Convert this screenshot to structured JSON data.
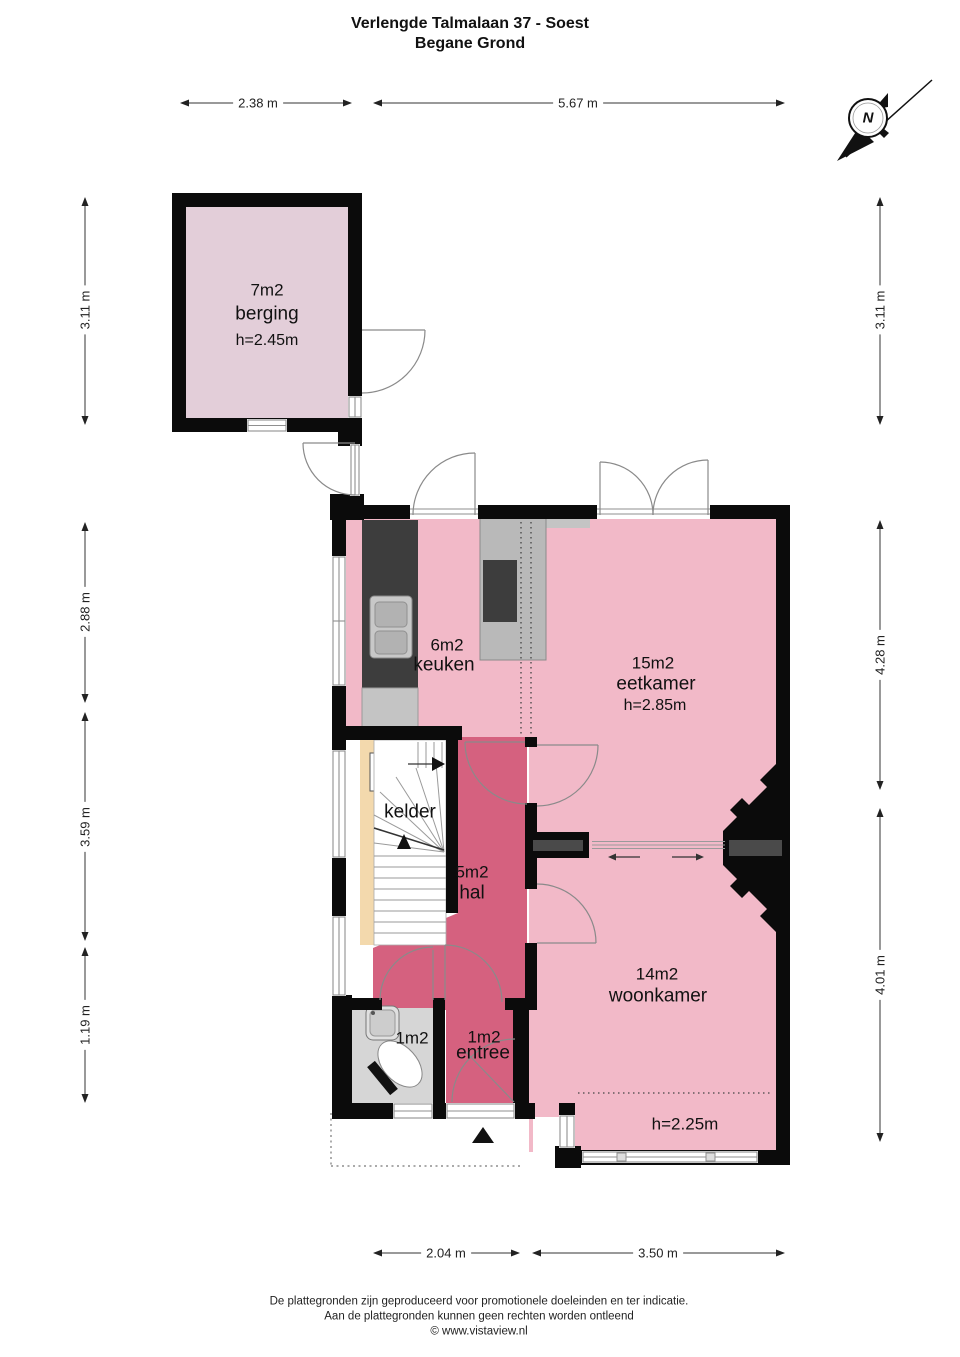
{
  "title": {
    "line1": "Verlengde Talmalaan 37 - Soest",
    "line2": "Begane Grond"
  },
  "compass": {
    "label": "N"
  },
  "rooms": {
    "berging": {
      "area": "7m2",
      "name": "berging",
      "height": "h=2.45m"
    },
    "keuken": {
      "area": "6m2",
      "name": "keuken"
    },
    "eetkamer": {
      "area": "15m2",
      "name": "eetkamer",
      "height": "h=2.85m"
    },
    "kelder": {
      "name": "kelder"
    },
    "hal": {
      "area": "5m2",
      "name": "hal"
    },
    "woonkamer": {
      "area": "14m2",
      "name": "woonkamer"
    },
    "toilet": {
      "area": "1m2"
    },
    "entree": {
      "area": "1m2",
      "name": "entree"
    },
    "ceiling_note": "h=2.25m"
  },
  "dimensions": {
    "top": [
      {
        "label": "2.38 m"
      },
      {
        "label": "5.67 m"
      }
    ],
    "bottom": [
      {
        "label": "2.04 m"
      },
      {
        "label": "3.50 m"
      }
    ],
    "left": [
      {
        "label": "3.11 m"
      },
      {
        "label": "2.88 m"
      },
      {
        "label": "3.59 m"
      },
      {
        "label": "1.19 m"
      }
    ],
    "right": [
      {
        "label": "3.11 m"
      },
      {
        "label": "4.28 m"
      },
      {
        "label": "4.01 m"
      }
    ]
  },
  "colors": {
    "room_pink": "#f2b9c8",
    "room_mauve": "#e3ced9",
    "hall_rose": "#d5617f",
    "toilet_gray": "#d6d6d6",
    "wall_black": "#0b0b0b",
    "counter_dark": "#3d3d3d",
    "counter_light": "#c4c4c4",
    "island_gray": "#b9b9b9",
    "wood_tan": "#f3d9ad"
  },
  "footer": {
    "line1": "De plattegronden zijn geproduceerd voor promotionele doeleinden en ter indicatie.",
    "line2": "Aan de plattegronden kunnen geen rechten worden ontleend",
    "line3": "© www.vistaview.nl"
  }
}
